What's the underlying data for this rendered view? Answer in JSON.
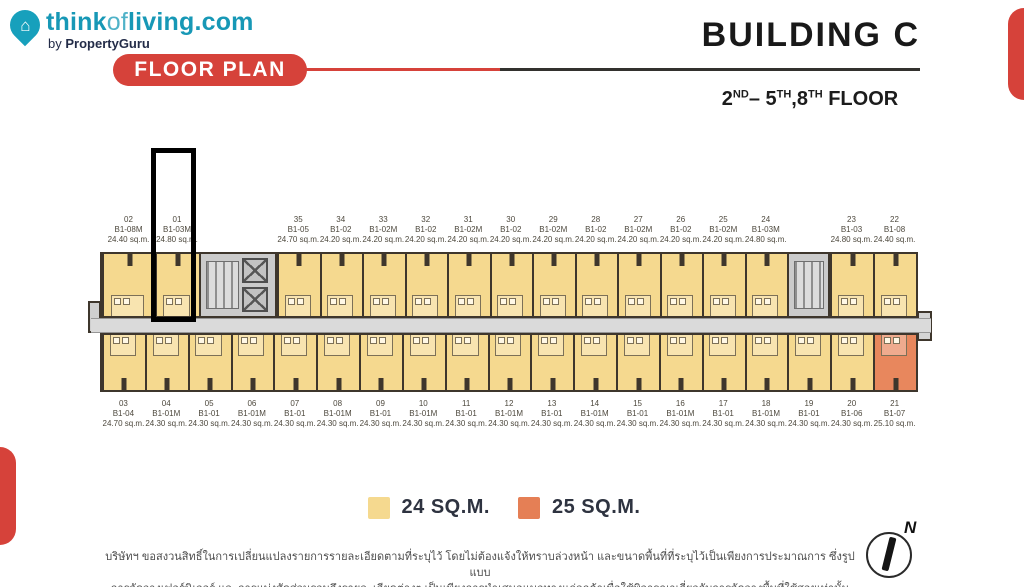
{
  "header": {
    "logo": {
      "think": "think",
      "of": "of",
      "living": "living.com",
      "by": "by",
      "property_guru": "PropertyGuru",
      "house_glyph": "⌂"
    },
    "badge": "FLOOR PLAN",
    "building_title": "BUILDING C",
    "floor_range": {
      "b1": "2",
      "s1": "ND",
      "b2": "– 5",
      "s2": "TH",
      "b3": ",8",
      "s3": "TH",
      "b4": " FLOOR"
    }
  },
  "colors": {
    "accent_red": "#D6423A",
    "brand_teal": "#1798B6",
    "unit_24sqm": "#F5D98F",
    "unit_25sqm": "#E8875D",
    "wall": "#3E362C",
    "corridor": "#DADADA",
    "core_gray": "#CBCBCB"
  },
  "floorplan": {
    "highlighted_unit": "01",
    "top_units": [
      {
        "no": "02",
        "code": "B1-08M",
        "area": "24.40 sq.m."
      },
      {
        "no": "01",
        "code": "B1-03M",
        "area": "24.80 sq.m."
      },
      {
        "no": "35",
        "code": "B1-05",
        "area": "24.70 sq.m."
      },
      {
        "no": "34",
        "code": "B1-02",
        "area": "24.20 sq.m."
      },
      {
        "no": "33",
        "code": "B1-02M",
        "area": "24.20 sq.m."
      },
      {
        "no": "32",
        "code": "B1-02",
        "area": "24.20 sq.m."
      },
      {
        "no": "31",
        "code": "B1-02M",
        "area": "24.20 sq.m."
      },
      {
        "no": "30",
        "code": "B1-02",
        "area": "24.20 sq.m."
      },
      {
        "no": "29",
        "code": "B1-02M",
        "area": "24.20 sq.m."
      },
      {
        "no": "28",
        "code": "B1-02",
        "area": "24.20 sq.m."
      },
      {
        "no": "27",
        "code": "B1-02M",
        "area": "24.20 sq.m."
      },
      {
        "no": "26",
        "code": "B1-02",
        "area": "24.20 sq.m."
      },
      {
        "no": "25",
        "code": "B1-02M",
        "area": "24.20 sq.m."
      },
      {
        "no": "24",
        "code": "B1-03M",
        "area": "24.80 sq.m."
      },
      {
        "no": "23",
        "code": "B1-03",
        "area": "24.80 sq.m."
      },
      {
        "no": "22",
        "code": "B1-08",
        "area": "24.40 sq.m."
      }
    ],
    "bottom_units": [
      {
        "no": "03",
        "code": "B1-04",
        "area": "24.70 sq.m."
      },
      {
        "no": "04",
        "code": "B1-01M",
        "area": "24.30 sq.m."
      },
      {
        "no": "05",
        "code": "B1-01",
        "area": "24.30 sq.m."
      },
      {
        "no": "06",
        "code": "B1-01M",
        "area": "24.30 sq.m."
      },
      {
        "no": "07",
        "code": "B1-01",
        "area": "24.30 sq.m."
      },
      {
        "no": "08",
        "code": "B1-01M",
        "area": "24.30 sq.m."
      },
      {
        "no": "09",
        "code": "B1-01",
        "area": "24.30 sq.m."
      },
      {
        "no": "10",
        "code": "B1-01M",
        "area": "24.30 sq.m."
      },
      {
        "no": "11",
        "code": "B1-01",
        "area": "24.30 sq.m."
      },
      {
        "no": "12",
        "code": "B1-01M",
        "area": "24.30 sq.m."
      },
      {
        "no": "13",
        "code": "B1-01",
        "area": "24.30 sq.m."
      },
      {
        "no": "14",
        "code": "B1-01M",
        "area": "24.30 sq.m."
      },
      {
        "no": "15",
        "code": "B1-01",
        "area": "24.30 sq.m."
      },
      {
        "no": "16",
        "code": "B1-01M",
        "area": "24.30 sq.m."
      },
      {
        "no": "17",
        "code": "B1-01",
        "area": "24.30 sq.m."
      },
      {
        "no": "18",
        "code": "B1-01M",
        "area": "24.30 sq.m."
      },
      {
        "no": "19",
        "code": "B1-01",
        "area": "24.30 sq.m."
      },
      {
        "no": "20",
        "code": "B1-06",
        "area": "24.30 sq.m."
      },
      {
        "no": "21",
        "code": "B1-07",
        "area": "25.10 sq.m.",
        "size_type": "25"
      }
    ]
  },
  "legend": {
    "items": [
      {
        "label": "24 SQ.M.",
        "color": "#F5D98F"
      },
      {
        "label": "25 SQ.M.",
        "color": "#E57F55"
      }
    ]
  },
  "compass": {
    "north": "N"
  },
  "disclaimer": {
    "line1": "บริษัทฯ ขอสงวนสิทธิ์ในการเปลี่ยนแปลงรายการรายละเอียดตามที่ระบุไว้ โดยไม่ต้องแจ้งให้ทราบล่วงหน้า และขนาดพื้นที่ที่ระบุไว้เป็นเพียงการประมาณการ ซึ่งรูปแบบ",
    "line2": "การจัดวางเฟอร์นิเจอร์ และการแบ่งสัดส่วนรวมถึงรายละเอียดต่างๆ เป็นเพียงการนำเสนอแนวทางแก่ลูกค้าเพื่อใช้พิจารณาเกี่ยวกับการจัดวางพื้นที่ใช้สอยเท่านั้น"
  }
}
